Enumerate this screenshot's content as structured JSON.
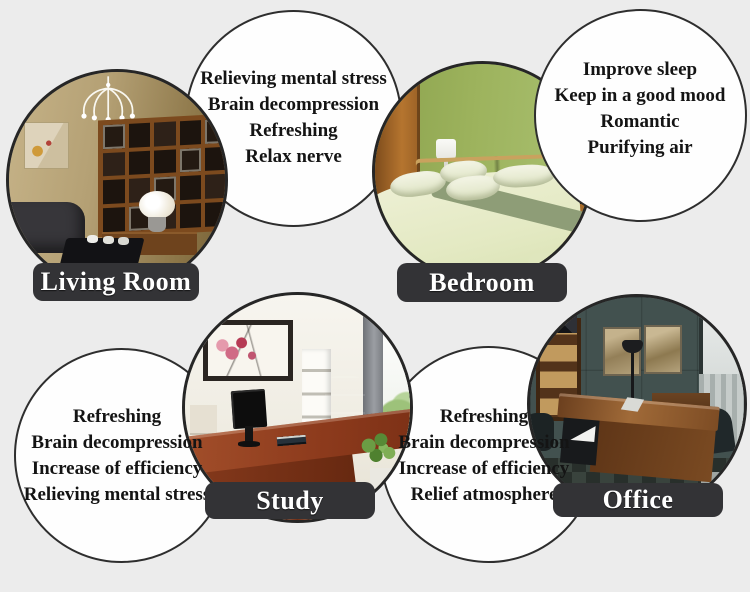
{
  "colors": {
    "background": "#ececec",
    "bubble_fill": "#fefefe",
    "bubble_border": "#2e2e2e",
    "label_bg": "#333336",
    "label_text": "#ffffff",
    "benefit_text": "#141414"
  },
  "sections": {
    "living_room": {
      "label": "Living Room",
      "photo": "living-room-interior-with-chandelier-and-shelving",
      "benefits": [
        "Relieving mental stress",
        "Brain decompression",
        "Refreshing",
        "Relax nerve"
      ]
    },
    "bedroom": {
      "label": "Bedroom",
      "photo": "green-bedroom-interior-with-bed-and-lamp",
      "benefits": [
        "Improve sleep",
        "Keep in a good mood",
        "Romantic",
        "Purifying air"
      ]
    },
    "study": {
      "label": "Study",
      "photo": "study-room-interior-with-desk-and-monitor",
      "benefits": [
        "Refreshing",
        "Brain decompression",
        "Increase of efficiency",
        "Relieving mental stress"
      ]
    },
    "office": {
      "label": "Office",
      "photo": "executive-office-interior-with-wooden-desk",
      "benefits": [
        "Refreshing",
        "Brain decompression",
        "Increase of efficiency",
        "Relief atmosphere"
      ]
    }
  }
}
